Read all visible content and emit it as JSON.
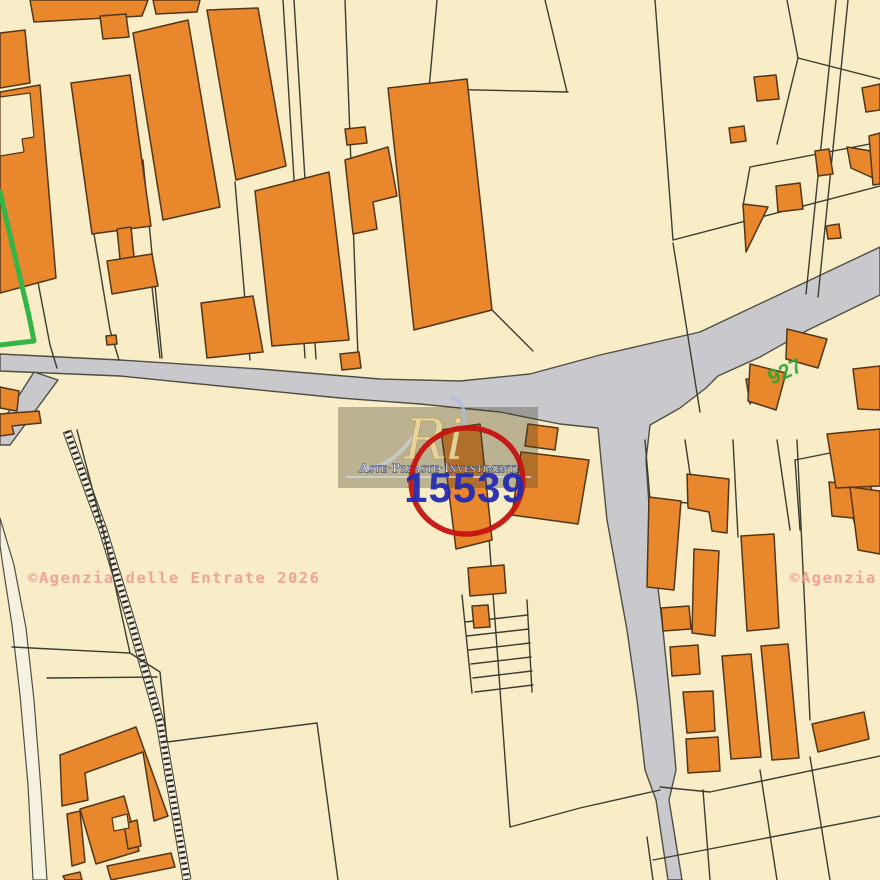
{
  "labels": {
    "parcel_number": "15539",
    "green_number": "927",
    "watermark_left": "©Agenzia delle Entrate 2026",
    "watermark_right": "©Agenzia",
    "logo_monogram": "Ri",
    "logo_name": "Aste·Preaste·Investimenti"
  },
  "colors": {
    "bg": "#f8edc6",
    "building": "#e8872b",
    "buildingStroke": "#53361a",
    "road": "#c9c9cd",
    "roadStroke": "#4e4e44",
    "boundary": "#3c3c30",
    "whiteRoad": "#f6f2e2",
    "green": "#33b54a",
    "greenLabel": "#2fa437",
    "red": "#c51310",
    "numberBlue": "#262cb0",
    "watermark": "#f2938a",
    "panel": "rgba(70,64,48,0.34)",
    "logoGold": "#e9d6a0",
    "logoText": "#e6e9ee",
    "logoTextShadow": "#1b2a62",
    "swoosh": "#c9ccd2",
    "wisp": "#a8bedd"
  },
  "map": {
    "roads": [
      "0,354 120,360 260,369 380,379 460,381 530,374 600,355 700,332 880,247 880,295 808,330 760,357 718,376 706,388 680,408 650,425 646,460 650,520 663,630 670,700 676,770 669,800 682,880 668,880 656,800 645,770 637,700 627,630 607,520 601,460 598,428 560,424 500,412 420,404 340,398 240,388 120,376 0,371",
      "34,372 58,380 10,445 0,445 0,425"
    ],
    "white_roads": [
      "0,518 14,565 26,628 34,700 41,790 47,880 33,880 28,785 20,695 12,625 2,560 0,545"
    ],
    "hatched_path": "M67,431 L103,530 L133,628 L160,722 L187,880",
    "boundaries": [
      "283,0 305,358",
      "294,0 316,359",
      "345,0 358,357",
      "437,0 429,89",
      "390,88 568,92",
      "545,0 567,92",
      "655,0 673,240",
      "673,240 880,186",
      "673,243 700,412",
      "787,0 798,58",
      "798,58 880,79",
      "798,58 777,144",
      "836,0 806,294",
      "848,0 818,297",
      "750,167 880,142",
      "750,167 743,206",
      "6,115 50,345 57,368",
      "80,150 110,330 119,360",
      "143,160 162,358",
      "235,182 250,360",
      "152,287 160,358",
      "12,647 130,653",
      "47,678 157,677",
      "77,430 103,530 130,653",
      "130,653 160,672 167,742 317,723",
      "317,723 338,880",
      "487,510 510,827",
      "510,827 580,808 660,790",
      "660,787 710,792 880,756",
      "653,860 880,816",
      "647,837 653,880",
      "703,790 710,880",
      "760,770 777,880",
      "810,757 830,880",
      "462,595 472,693",
      "527,600 532,692",
      "465,622 528,615",
      "467,636 529,629",
      "469,650 530,643",
      "471,664 531,657",
      "473,678 532,671",
      "475,692 533,685",
      "645,440 650,500",
      "685,440 690,474",
      "733,440 738,537",
      "777,440 790,530",
      "797,440 810,720",
      "650,500 688,503",
      "795,460 880,443",
      "795,460 800,530",
      "492,310 533,351"
    ],
    "buildings": [
      "30,0 148,0 142,16 34,22",
      "100,16 126,14 129,37 103,39",
      "153,0 200,0 197,12 156,14",
      "207,10 258,8 286,166 236,180",
      "133,33 188,20 220,207 163,220",
      "71,83 130,75 151,226 92,234",
      "117,229 131,227 134,257 120,259",
      "107,261 152,254 158,286 112,294",
      "0,33 25,30 30,83 0,88",
      "0,92 40,85 56,278 0,293",
      "0,387 19,391 17,411 0,408",
      "0,414 39,411 41,423 12,426 14,434 0,436",
      "106,336 116,335 117,344 107,345",
      "340,354 359,352 361,368 342,370",
      "345,129 365,127 367,143 347,145",
      "255,191 329,172 349,340 272,346",
      "201,303 253,296 263,352 207,358",
      "345,160 388,147 397,196 373,202 377,229 353,234",
      "388,88 467,79 492,310 414,330",
      "441,430 480,424 492,540 456,549",
      "468,568 504,565 506,593 470,596",
      "472,606 488,605 490,627 474,628",
      "528,424 558,428 555,450 525,446",
      "521,452 589,460 578,524 512,515",
      "746,379 764,382 750,404",
      "649,497 681,501 674,590 647,587",
      "687,474 729,479 727,533 712,531 709,512 688,508",
      "694,549 719,551 715,636 692,633",
      "741,536 774,534 779,628 747,631",
      "661,608 689,606 691,629 663,631",
      "670,647 698,645 700,674 672,676",
      "683,692 713,691 715,731 687,733",
      "686,739 718,737 720,771 688,773",
      "722,656 751,654 761,757 731,759",
      "761,646 788,644 799,758 772,760",
      "812,724 864,712 869,739 818,752",
      "829,482 871,486 877,529 856,527 853,518 832,516",
      "815,151 829,149 833,174 818,176",
      "847,147 871,151 873,178 851,168",
      "776,186 800,183 803,209 778,212",
      "743,204 768,207 746,252",
      "826,226 839,224 841,238 828,239",
      "862,88 880,84 880,110 866,112",
      "869,136 880,133 880,184 873,185",
      "754,77 776,75 779,99 757,101",
      "729,128 744,126 746,141 731,143",
      "750,364 786,373 776,410 748,401",
      "787,329 827,339 818,368 786,359",
      "853,369 880,366 880,410 858,409",
      "827,434 880,429 880,486 836,488",
      "850,487 880,491 880,554 858,550",
      "60,755 136,727 168,816 154,821 143,752 85,773 88,800 62,806",
      "80,809 124,796 139,851 96,864",
      "124,824 137,820 141,846 128,849",
      "67,814 80,811 85,862 72,866",
      "107,866 171,853 175,867 111,880",
      "63,876 80,872 82,880 65,880"
    ],
    "cream_patches": [
      "0,97 30,93 34,137 22,139 24,152 0,156",
      "112,818 127,814 129,828 114,831"
    ],
    "green_boundary": "0,192 29,316 34,341 0,345",
    "red_circle": {
      "cx": 467,
      "cy": 481,
      "rx": 56,
      "ry": 53,
      "rotate": -10
    }
  }
}
